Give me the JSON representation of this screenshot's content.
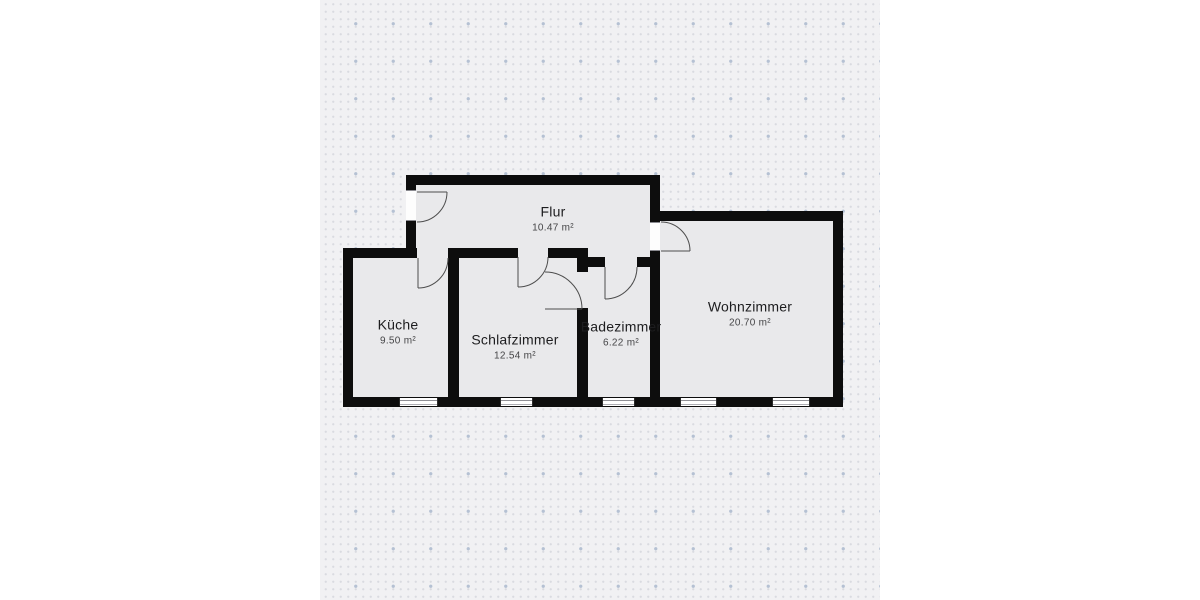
{
  "rooms": [
    {
      "name": "Flur",
      "area": "10.47 m²"
    },
    {
      "name": "Küche",
      "area": "9.50 m²"
    },
    {
      "name": "Schlafzimmer",
      "area": "12.54 m²"
    },
    {
      "name": "Badezimmer",
      "area": "6.22 m²"
    },
    {
      "name": "Wohnzimmer",
      "area": "20.70 m²"
    }
  ],
  "colors": {
    "page_background": "#ffffff",
    "canvas_background": "#f1f1f3",
    "grid_dot_small": "#d9dbe0",
    "grid_dot_large": "#b5c1d3",
    "wall": "#0d0d0d",
    "floor": "#e9e9eb",
    "window": "#ffffff",
    "door_line": "#4d4d4d",
    "room_name_text": "#1d1d1f",
    "room_area_text": "#454547"
  }
}
